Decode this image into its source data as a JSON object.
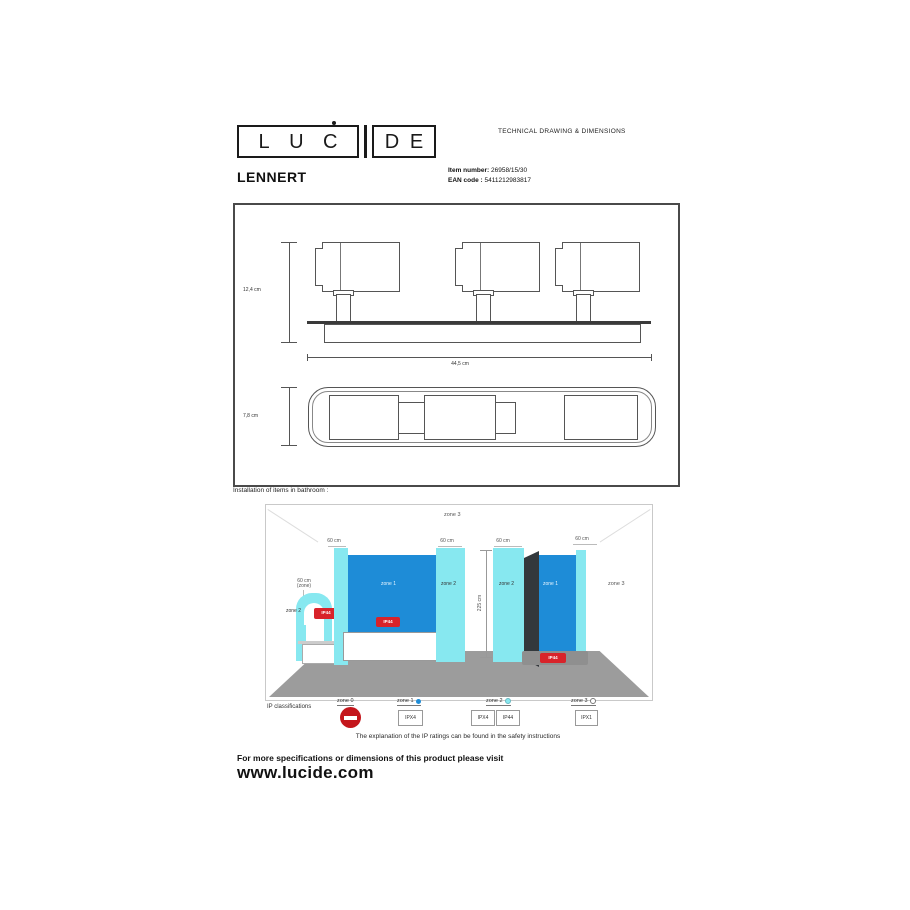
{
  "header": {
    "logo_letters": [
      "L",
      "U",
      "C",
      "D",
      "E"
    ],
    "doc_type": "TECHNICAL DRAWING & DIMENSIONS"
  },
  "product": {
    "name": "LENNERT",
    "item_label": "Item number:",
    "item_value": "26958/15/30",
    "ean_label": "EAN code :",
    "ean_value": "5411212983817"
  },
  "drawing": {
    "height_label": "12,4 cm",
    "width_label": "44,5 cm",
    "depth_label": "7,8 cm"
  },
  "bathroom": {
    "title": "Installation of items in bathroom :",
    "ceiling_zone": "zone 3",
    "top_dims": [
      "60 cm",
      "60 cm",
      "60 cm",
      "60 cm"
    ],
    "wall_height": "225 cm",
    "basin_note_line1": "60 cm",
    "basin_note_line2": "(zone)",
    "zone1_label": "zone 1",
    "zone2_label": "zone 2",
    "zone3_label": "zone 3",
    "badge_text": "IP44"
  },
  "legend": {
    "title": "IP classifications",
    "zones": [
      {
        "label": "zone 0",
        "boxes": []
      },
      {
        "label": "zone 1",
        "boxes": [
          "IPX4"
        ]
      },
      {
        "label": "zone 2",
        "boxes": [
          "IPX4",
          "IP44"
        ]
      },
      {
        "label": "zone 3",
        "boxes": [
          "IPX1"
        ]
      }
    ],
    "note": "The explanation of the IP ratings can be found in the safety instructions"
  },
  "footer": {
    "line1": "For more specifications or dimensions of this product please visit",
    "line2": "www.lucide.com"
  },
  "colors": {
    "zone1_blue": "#1e8cd7",
    "zone2_cyan": "#87e8f0",
    "floor_gray": "#9c9c9c",
    "badge_red": "#d8232a",
    "prohibit_red": "#c4161c"
  }
}
